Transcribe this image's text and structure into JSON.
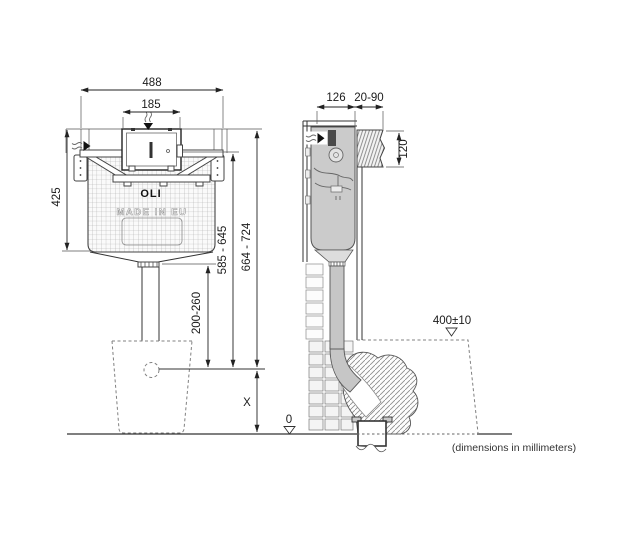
{
  "drawing": {
    "type": "installation-diagram",
    "product": "concealed cistern with frame",
    "footnote": "(dimensions in millimeters)"
  },
  "branding": {
    "logo": "OLI",
    "origin": "MADE IN EU"
  },
  "front_view": {
    "dims": {
      "overall_width": "488",
      "access_panel_width": "185",
      "tank_height": "425",
      "flush_pipe_range": "200-260",
      "panel_height_range": "585 - 645",
      "top_height_range": "664 - 724",
      "bowl_inlet_height": "X",
      "floor_datum": "0"
    }
  },
  "side_view": {
    "dims": {
      "cistern_depth": "126",
      "wall_thickness_range": "20-90",
      "recess_height": "120",
      "bowl_rim_height": "400±10"
    }
  },
  "colors": {
    "tank_fill": "#cbcbcb",
    "line": "#333333",
    "hatch": "#8a8a8a"
  }
}
